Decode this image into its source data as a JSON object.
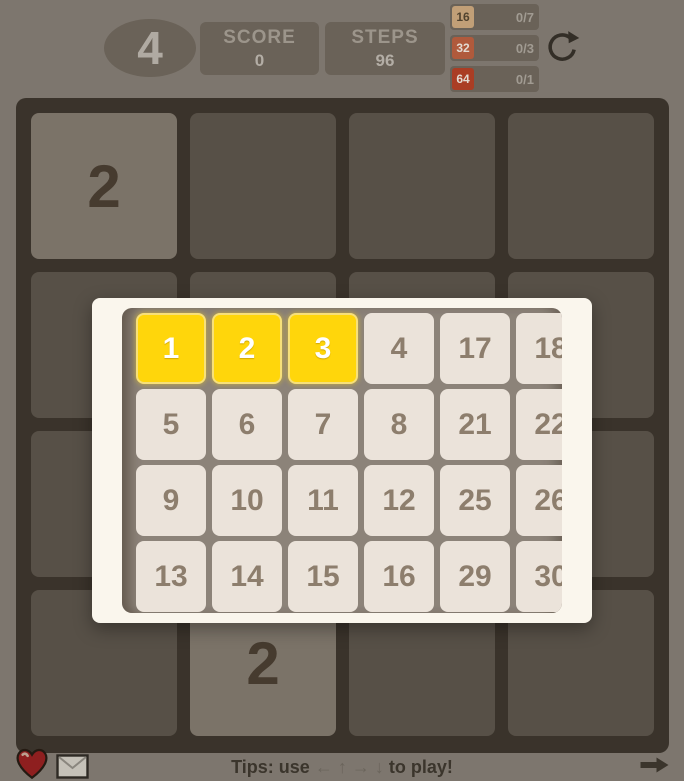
{
  "header": {
    "next_goal_tile": "4",
    "score_label": "SCORE",
    "score_value": "0",
    "steps_label": "STEPS",
    "steps_value": "96",
    "goals": [
      {
        "tile": "16",
        "progress": "0/7"
      },
      {
        "tile": "32",
        "progress": "0/3"
      },
      {
        "tile": "64",
        "progress": "0/1"
      }
    ]
  },
  "board": {
    "grid": [
      [
        "2",
        "",
        "",
        ""
      ],
      [
        "",
        "",
        "",
        ""
      ],
      [
        "",
        "",
        "",
        ""
      ],
      [
        "",
        "2",
        "",
        ""
      ]
    ]
  },
  "level_picker": {
    "rows": [
      [
        "1",
        "2",
        "3",
        "4",
        "17",
        "18"
      ],
      [
        "5",
        "6",
        "7",
        "8",
        "21",
        "22"
      ],
      [
        "9",
        "10",
        "11",
        "12",
        "25",
        "26"
      ],
      [
        "13",
        "14",
        "15",
        "16",
        "29",
        "30"
      ]
    ],
    "completed_levels": [
      "1",
      "2",
      "3"
    ]
  },
  "footer": {
    "tips_prefix": "Tips: use ",
    "tips_arrows": "← ↑ → ↓",
    "tips_suffix": " to play!"
  },
  "colors": {
    "page_bg": "#7d766e",
    "board_bg": "#3a332b",
    "empty_cell": "#575047",
    "tile_2": "#7b7368",
    "level_done_yellow": "#ffd60b",
    "level_normal": "#ebe3da",
    "goal_16": "#c19f77",
    "goal_32": "#b05a3c",
    "goal_64": "#aa3d24",
    "heart_red": "#8e1f1f"
  }
}
